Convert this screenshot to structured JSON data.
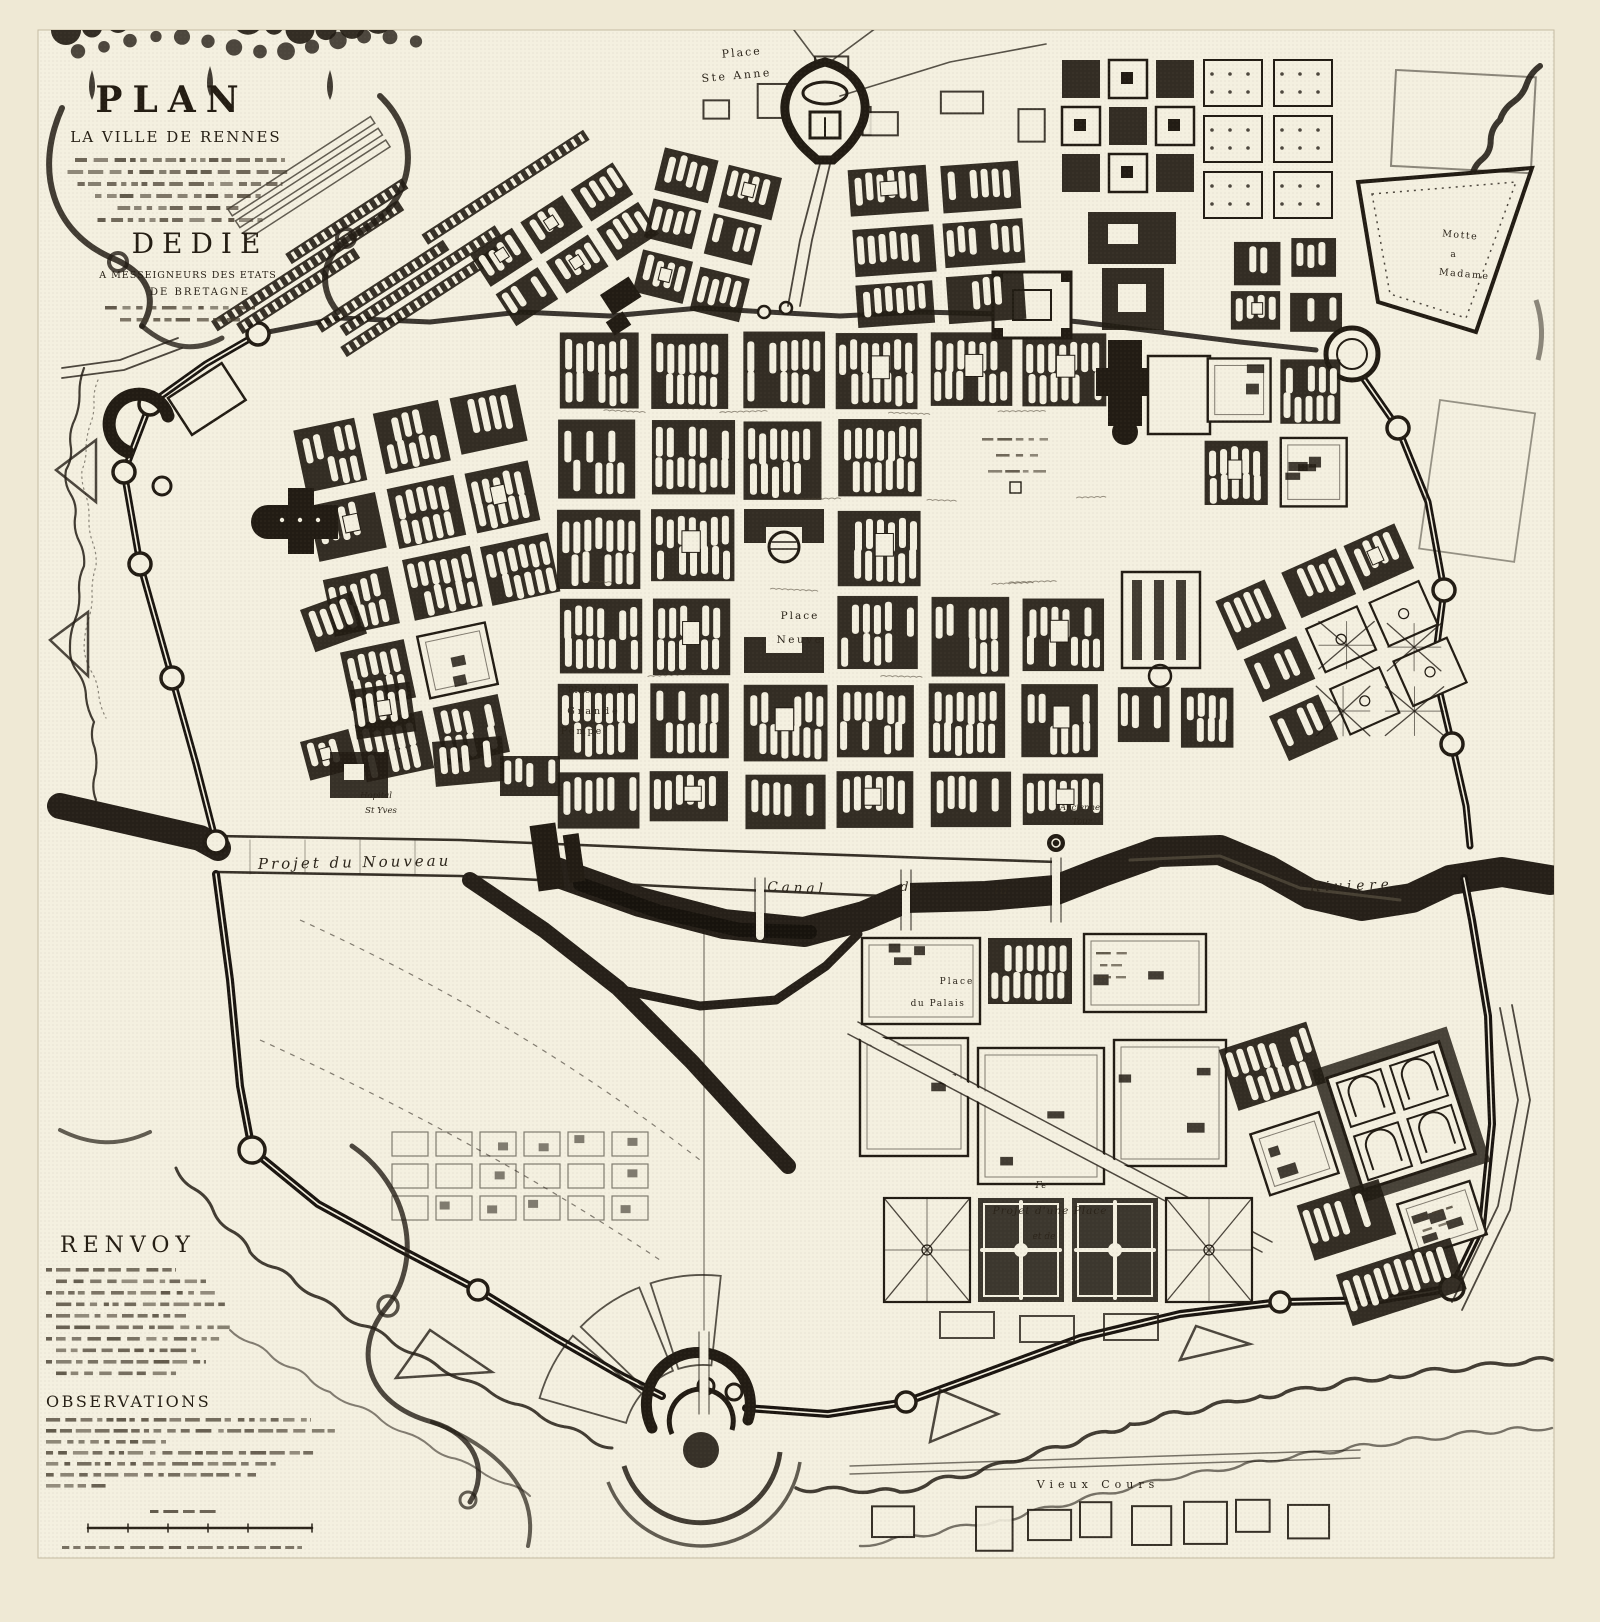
{
  "map": {
    "title": {
      "plan": "PLAN",
      "line2": "LA VILLE DE RENNES",
      "dedie": "DEDIE",
      "line4": "A MESSEIGNEURS DES ETATS",
      "line5": "DE BRETAGNE"
    },
    "legend": {
      "renvoy": "RENVOY",
      "observations": "OBSERVATIONS"
    },
    "labels": [
      {
        "id": "place-ste-anne-1",
        "text": "Place"
      },
      {
        "id": "place-ste-anne-2",
        "text": "Ste Anne"
      },
      {
        "id": "motte-1",
        "text": "Motte"
      },
      {
        "id": "motte-2",
        "text": "a"
      },
      {
        "id": "motte-3",
        "text": "Madame"
      },
      {
        "id": "place-neuve-1",
        "text": "Place"
      },
      {
        "id": "place-neuve-2",
        "text": "Neuve"
      },
      {
        "id": "grande-pompe-1",
        "text": "Place de la"
      },
      {
        "id": "grande-pompe-2",
        "text": "Grande"
      },
      {
        "id": "grande-pompe-3",
        "text": "Pompe"
      },
      {
        "id": "hopital-1",
        "text": "Hopital"
      },
      {
        "id": "hopital-2",
        "text": "St Yves"
      },
      {
        "id": "ancienne-tour-1",
        "text": "Ancienne"
      },
      {
        "id": "ancienne-tour-2",
        "text": "Tour"
      },
      {
        "id": "projet-nouveau",
        "text": "Projet du Nouveau"
      },
      {
        "id": "canal",
        "text": "Canal"
      },
      {
        "id": "canal-de",
        "text": "de"
      },
      {
        "id": "canal-la",
        "text": "la"
      },
      {
        "id": "riviere",
        "text": "Riviere"
      },
      {
        "id": "place-palais-1",
        "text": "Place"
      },
      {
        "id": "place-palais-2",
        "text": "du Palais"
      },
      {
        "id": "projet-place-0",
        "text": "Fe"
      },
      {
        "id": "projet-place-1",
        "text": "Projet d'une Place"
      },
      {
        "id": "projet-place-2",
        "text": "et de"
      },
      {
        "id": "vieux-cours",
        "text": "Vieux Cours"
      }
    ],
    "colors": {
      "paper": "#efe9d5",
      "plate": "#f4f0e0",
      "ink": "#221c14",
      "water": "#262019"
    }
  }
}
